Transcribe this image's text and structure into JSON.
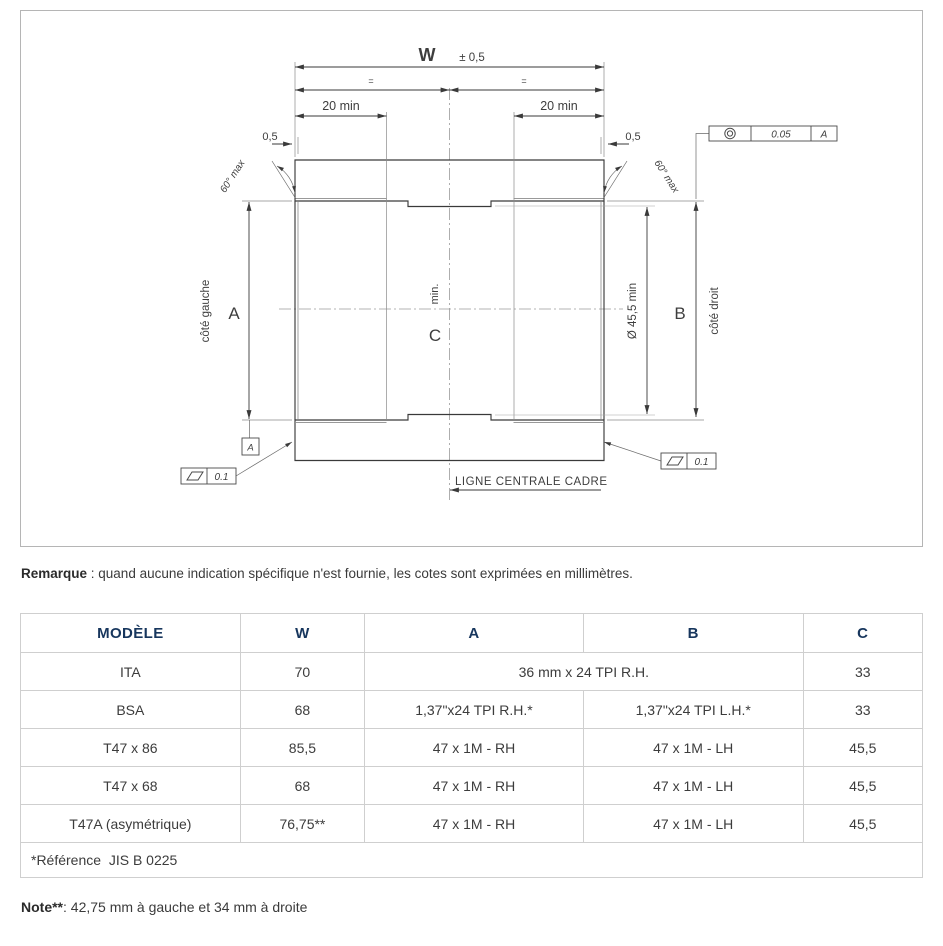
{
  "diagram": {
    "labels": {
      "width": "W",
      "width_tol": "± 0,5",
      "equal_mark": "=",
      "thread_length": "20 min",
      "chamfer": "0,5",
      "chamfer_angle": "60° max",
      "dim_a": "A",
      "dim_b": "B",
      "dim_c": "C",
      "c_min": "min.",
      "bore_dia": "Ø 45,5 min",
      "left_side": "côté gauche",
      "right_side": "côté droit",
      "centerline": "LIGNE CENTRALE CADRE",
      "datum": "A",
      "flatness_tol": "0.1",
      "concentricity_tol": "0.05",
      "concentricity_datum": "A"
    }
  },
  "remarque": {
    "label": "Remarque",
    "text": " : quand aucune indication spécifique n'est fournie, les cotes sont exprimées en millimètres."
  },
  "table": {
    "headers": [
      "MODÈLE",
      "W",
      "A",
      "B",
      "C"
    ],
    "rows": [
      {
        "model": "ITA",
        "w": "70",
        "ab": "36 mm x 24 TPI R.H.",
        "c": "33"
      },
      {
        "model": "BSA",
        "w": "68",
        "a": "1,37\"x24 TPI R.H.*",
        "b": "1,37\"x24 TPI L.H.*",
        "c": "33"
      },
      {
        "model": "T47 x 86",
        "w": "85,5",
        "a": "47 x 1M - RH",
        "b": "47 x 1M - LH",
        "c": "45,5"
      },
      {
        "model": "T47 x 68",
        "w": "68",
        "a": "47 x 1M - RH",
        "b": "47 x 1M - LH",
        "c": "45,5"
      },
      {
        "model": "T47A (asymétrique)",
        "w": "76,75**",
        "a": "47 x 1M - RH",
        "b": "47 x 1M - LH",
        "c": "45,5"
      }
    ],
    "footer": "*Référence  JIS B 0225"
  },
  "note": {
    "label": "Note**",
    "text": ": 42,75 mm à gauche et 34 mm à droite"
  },
  "colors": {
    "header_text": "#17365d",
    "hatch_fill": "#dcdcdc",
    "hatch_line": "#9b9b9b",
    "border": "#b5b5b5"
  }
}
